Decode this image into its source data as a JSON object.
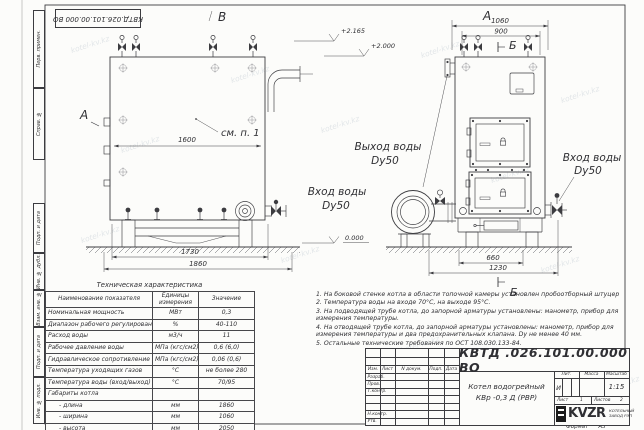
{
  "watermark": "kotel-kv.kz",
  "frame": {
    "doc_number_top": "КВТД.026.101.00.000  ВО",
    "margin_labels": [
      "Перв. примен.",
      "Справ. №",
      "Подп. и дата",
      "Инв. № дубл.",
      "Взам. инв. №",
      "Подп. и дата",
      "Инв. № подл."
    ],
    "format_label": "Формат",
    "format_value": "А3"
  },
  "views": {
    "markers": {
      "top_view_letter": "В",
      "section_a_arrow": "А",
      "right_view_letter": "А",
      "section_b_top": "Б",
      "section_b_bottom": "Б",
      "callout": "см. п. 1"
    },
    "left": {
      "dim_inner": "1600",
      "dim_len1": "1730",
      "dim_len2": "1860"
    },
    "right": {
      "dim_w1": "1060",
      "dim_w2": "900",
      "dim_b1": "660",
      "dim_b2": "1230"
    },
    "elevations": {
      "v1": "+2.165",
      "v2": "+2.000",
      "v0": "0.000"
    },
    "labels": {
      "outlet_l1": "Выход воды",
      "outlet_l2": "Dy50",
      "inlet_mid_l1": "Вход воды",
      "inlet_mid_l2": "Dy50",
      "inlet_right_l1": "Вход воды",
      "inlet_right_l2": "Dy50"
    }
  },
  "tech_table": {
    "title": "Техническая характеристика",
    "headers": [
      "Наименование показателя",
      "Единицы измерения",
      "Значение"
    ],
    "rows": [
      [
        "Номинальная мощность",
        "МВт",
        "0,3"
      ],
      [
        "Диапазон рабочего регулирования",
        "%",
        "40-110"
      ],
      [
        "Расход воды",
        "м3/ч",
        "11"
      ],
      [
        "Рабочее давление воды",
        "МПа (кгс/см2)",
        "0,6 (6,0)"
      ],
      [
        "Гидравлическое сопротивление котла",
        "МПа (кгс/см2)",
        "0,06 (0,6)"
      ],
      [
        "Температура уходящих газов",
        "°С",
        "не более 280"
      ],
      [
        "Температура воды (вход/выход)",
        "°С",
        "70/95"
      ],
      [
        "Габариты котла",
        "",
        ""
      ],
      [
        "- длина",
        "мм",
        "1860"
      ],
      [
        "- ширина",
        "мм",
        "1060"
      ],
      [
        "- высота",
        "мм",
        "2050"
      ]
    ]
  },
  "notes": [
    "1. На боковой стенке котла в области топочной камеры установлен пробоотборный штуцер",
    "2. Температура воды на входе 70°С, на выходе 95°С.",
    "3. На подводящей трубе котла, до запорной арматуры установлены: манометр, прибор для измерения температуры.",
    "4. На отводящей трубе котла, до запорной арматуры установлены: манометр, прибор для измерения температуры и два предохранительных клапана. Dу не менее 40 мм.",
    "5. Остальные технические требования по ОСТ 108.030.133-84."
  ],
  "title_block": {
    "designation": "КВТД .026.101.00.000  ВО",
    "product_line1": "Котел водогрейный",
    "product_line2": "КВр -0,3  Д  (РВР)",
    "header_cols": [
      "Изм.",
      "Лист",
      "N докум.",
      "Подп.",
      "Дата"
    ],
    "row_labels": [
      "Разраб.",
      "Пров.",
      "Т.контр.",
      "Н.контр.",
      "Утв."
    ],
    "lit_headers": [
      "Лит.",
      "Масса",
      "Масштаб"
    ],
    "lit_value": "И",
    "scale": "1:15",
    "sheet_label": "Лист",
    "sheet_value": "1",
    "sheets_label": "Листов",
    "sheets_value": "2",
    "logo_text": "KVZR",
    "logo_sub1": "КОТЕЛЬНЫЙ",
    "logo_sub2": "ЗАВОД РЭП"
  }
}
